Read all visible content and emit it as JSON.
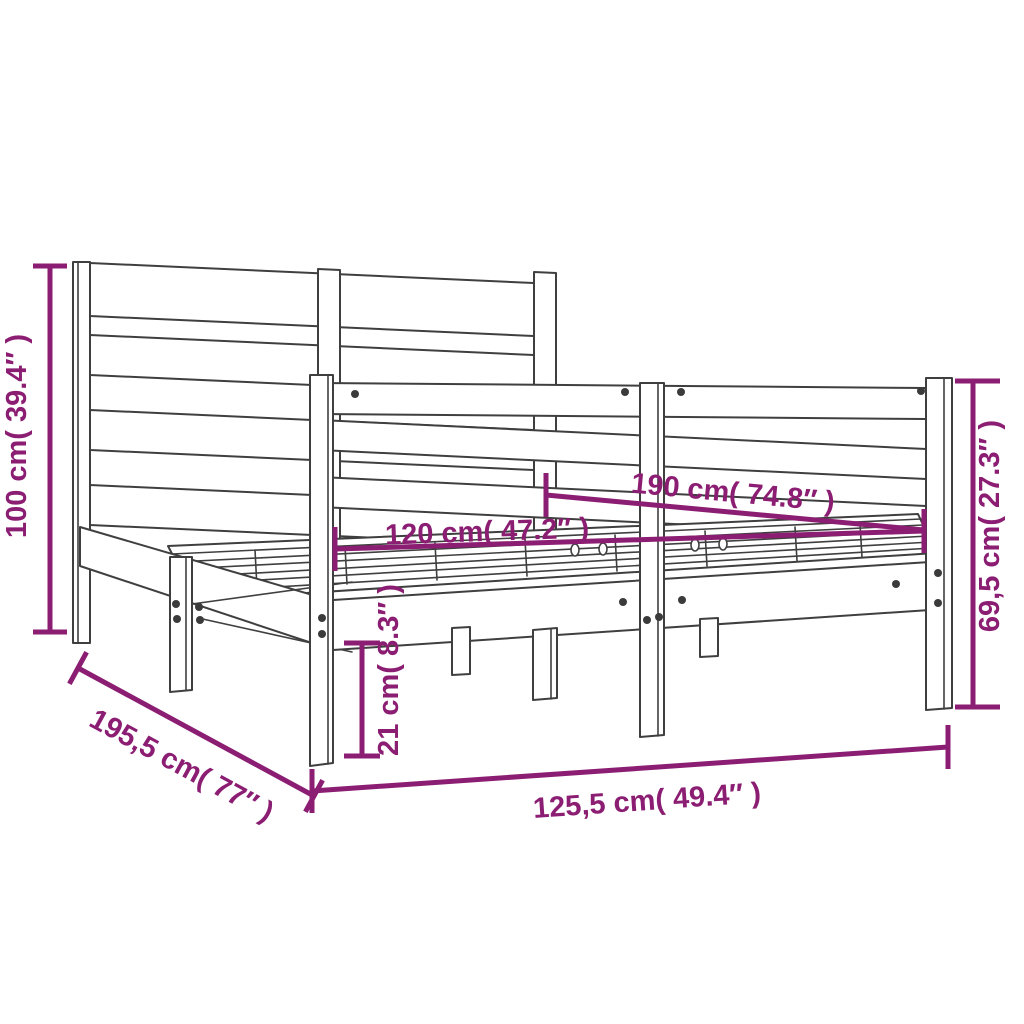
{
  "figure": {
    "type": "product-dimension-diagram",
    "subject": "wooden bed frame with headboard, line drawing with dimension annotations"
  },
  "dims": {
    "headboard_height": "100 cm( 39.4″ )",
    "total_length": "195,5 cm( 77″ )",
    "total_width": "125,5 cm( 49.4″ )",
    "inner_width": "120 cm( 47.2″ )",
    "inner_length": "190 cm( 74.8″ )",
    "side_height": "69,5 cm( 27.3″ )",
    "ground_clearance": "21 cm( 8.3″ )"
  },
  "colors": {
    "dimension": "#8B1D72",
    "outline": "#3f3f3f",
    "background": "#ffffff",
    "screw": "#3b3b3b"
  }
}
